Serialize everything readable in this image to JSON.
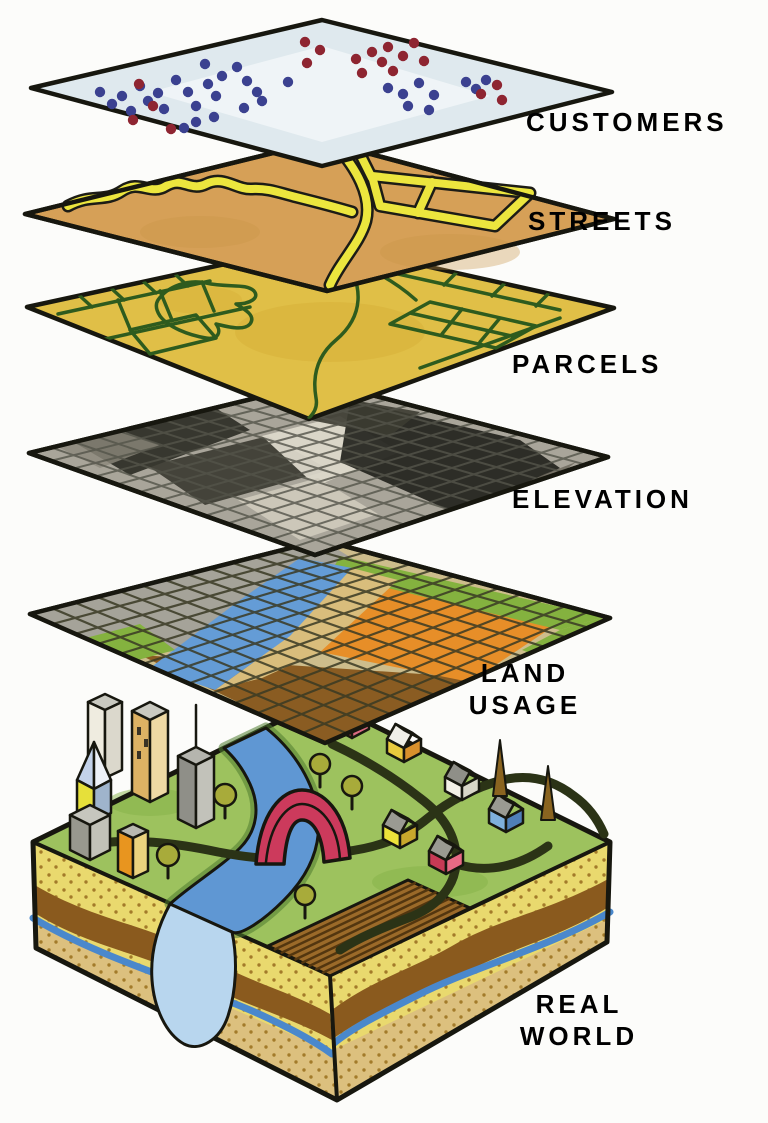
{
  "diagram": {
    "background": "#fcfcfa",
    "ink": "#17170f",
    "label_color": "#151515",
    "labels": {
      "customers": "CUSTOMERS",
      "streets": "STREETS",
      "parcels": "PARCELS",
      "elevation": "ELEVATION",
      "land_usage_line1": "LAND",
      "land_usage_line2": "USAGE",
      "real_world_line1": "REAL",
      "real_world_line2": "WORLD"
    },
    "customers": {
      "surface": "#dfe9ee",
      "highlight": "#ffffff",
      "dot_blue": "#3b4190",
      "dot_red": "#8e2531"
    },
    "customer_points": {
      "blue": [
        [
          100,
          92
        ],
        [
          112,
          104
        ],
        [
          122,
          96
        ],
        [
          131,
          111
        ],
        [
          140,
          86
        ],
        [
          148,
          101
        ],
        [
          158,
          93
        ],
        [
          164,
          109
        ],
        [
          176,
          80
        ],
        [
          188,
          92
        ],
        [
          196,
          106
        ],
        [
          205,
          64
        ],
        [
          208,
          84
        ],
        [
          216,
          96
        ],
        [
          222,
          76
        ],
        [
          237,
          67
        ],
        [
          247,
          81
        ],
        [
          257,
          92
        ],
        [
          196,
          122
        ],
        [
          214,
          117
        ],
        [
          184,
          128
        ],
        [
          244,
          108
        ],
        [
          262,
          101
        ],
        [
          288,
          82
        ],
        [
          388,
          88
        ],
        [
          403,
          94
        ],
        [
          419,
          83
        ],
        [
          434,
          95
        ],
        [
          408,
          106
        ],
        [
          429,
          110
        ],
        [
          466,
          82
        ],
        [
          476,
          89
        ],
        [
          486,
          80
        ]
      ],
      "red": [
        [
          139,
          84
        ],
        [
          133,
          120
        ],
        [
          153,
          106
        ],
        [
          171,
          129
        ],
        [
          305,
          42
        ],
        [
          320,
          50
        ],
        [
          307,
          63
        ],
        [
          356,
          59
        ],
        [
          372,
          52
        ],
        [
          382,
          62
        ],
        [
          388,
          47
        ],
        [
          403,
          56
        ],
        [
          414,
          43
        ],
        [
          424,
          61
        ],
        [
          393,
          71
        ],
        [
          362,
          73
        ],
        [
          481,
          94
        ],
        [
          497,
          85
        ],
        [
          502,
          100
        ]
      ]
    },
    "streets": {
      "surface": "#d6a057",
      "road_fill": "#ece63e",
      "road_casing": "#1c1c16"
    },
    "parcels": {
      "surface": "#e0bf47",
      "boundary": "#2e5b1e"
    },
    "elevation": {
      "surface": "#a9a59a",
      "grid": "#54544a"
    },
    "land_usage": {
      "surface": "#cdbd8c",
      "grid": "#3a3a24",
      "zones": {
        "urban": "#a5a399",
        "water": "#649cd6",
        "parks": "#84b23f",
        "residential": "#d9bd7c",
        "commercial": "#e78e28",
        "agriculture": "#8a5c22"
      }
    },
    "real_world": {
      "colors": {
        "grass": "#9dc25e",
        "grass_shade": "#86b248",
        "river": "#5f97d3",
        "pond": "#b8d6ee",
        "bridge": "#cc3a5c",
        "road": "#2b3316",
        "sand": "#e9d96e",
        "sand_dots": "#a37b2a",
        "soil_band": "#8a5a1e",
        "groundwater": "#4a88cc",
        "lower_sand": "#dcc07e",
        "field": "#9b6a29",
        "field_rows": "#53360f",
        "tree": "#a8ab3a",
        "cone_tree": "#8a6420"
      },
      "houses": [
        {
          "sw_wall": "#c33b52",
          "se_wall": "#d96a80",
          "sw_roof": "#9a9a92",
          "ne_roof": "#eceae0"
        },
        {
          "sw_wall": "#e9ca3d",
          "se_wall": "#d8902c",
          "sw_roof": "#f0efe8",
          "ne_roof": "#b0b0a6"
        },
        {
          "sw_wall": "#f2f0e6",
          "se_wall": "#d8d6c8",
          "sw_roof": "#8f8f88",
          "ne_roof": "#f4f2ea"
        },
        {
          "sw_wall": "#7fb0dc",
          "se_wall": "#4f7fb8",
          "sw_roof": "#9a9a92",
          "ne_roof": "#f0efe8"
        },
        {
          "sw_wall": "#ece23a",
          "se_wall": "#c8a82c",
          "sw_roof": "#9a9a92",
          "ne_roof": "#eceade"
        },
        {
          "sw_wall": "#c83a55",
          "se_wall": "#e86a85",
          "sw_roof": "#9a9a92",
          "ne_roof": "#d8d6cc"
        }
      ],
      "buildings": {
        "white_tower": {
          "left": "#efece0",
          "right": "#dbd8cc",
          "top": "#c9c9c0"
        },
        "tan_tower": {
          "left": "#ddb264",
          "right": "#eed9a4",
          "top": "#c9c9c0",
          "window": "#3a3326"
        },
        "antenna_tower": {
          "left": "#8f8f88",
          "right": "#c2c2ba",
          "top": "#b5b5ae"
        },
        "spire": {
          "pyr_left": "#c3d2ea",
          "pyr_right": "#eef2f8",
          "body_left": "#e6e03a",
          "body_right": "#9fb4cc"
        },
        "gray_block": {
          "left": "#98988e",
          "right": "#c2c2b8",
          "top": "#c6c6be"
        },
        "orange_block": {
          "left": "#e8951f",
          "right": "#ead27e",
          "top": "#b9b9b0"
        }
      }
    }
  }
}
